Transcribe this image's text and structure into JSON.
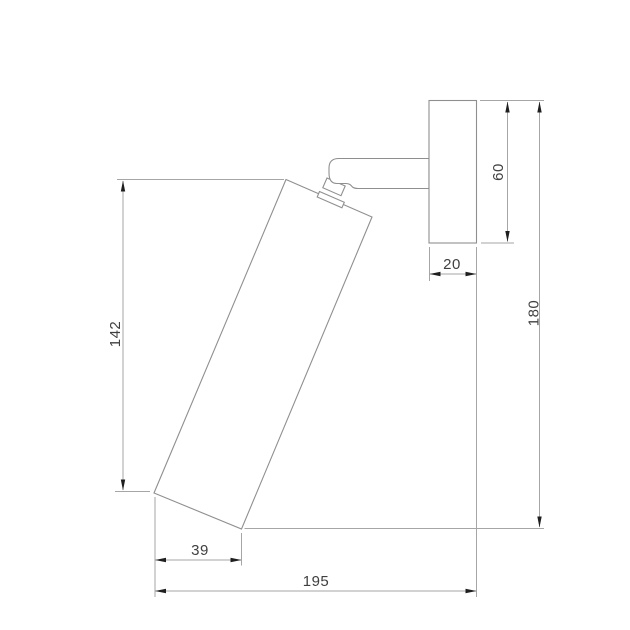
{
  "drawing": {
    "type": "technical-dimension-drawing",
    "subject": "wall-mounted spotlight, side view",
    "units": "mm",
    "background_color": "#ffffff",
    "colors": {
      "outline": "#8f8f8f",
      "dimension_line": "#a6a6a6",
      "arrow": "#1f1f1f",
      "text": "#404040"
    },
    "parts": [
      {
        "name": "wall-plate",
        "description": "rectangular wall mount plate"
      },
      {
        "name": "mounting-arm",
        "description": "horizontal arm from wall plate"
      },
      {
        "name": "swivel-joint",
        "description": "pivot neck with collar"
      },
      {
        "name": "lamp-body",
        "description": "tilted cylindrical spot head"
      }
    ],
    "dimensions": [
      {
        "name": "body-height",
        "label": "142",
        "value": 142,
        "orientation": "vertical"
      },
      {
        "name": "plate-depth",
        "label": "20",
        "value": 20,
        "orientation": "horizontal"
      },
      {
        "name": "plate-height",
        "label": "60",
        "value": 60,
        "orientation": "vertical"
      },
      {
        "name": "overall-height",
        "label": "180",
        "value": 180,
        "orientation": "vertical"
      },
      {
        "name": "head-offset",
        "label": "39",
        "value": 39,
        "orientation": "horizontal"
      },
      {
        "name": "overall-depth",
        "label": "195",
        "value": 195,
        "orientation": "horizontal"
      }
    ]
  }
}
